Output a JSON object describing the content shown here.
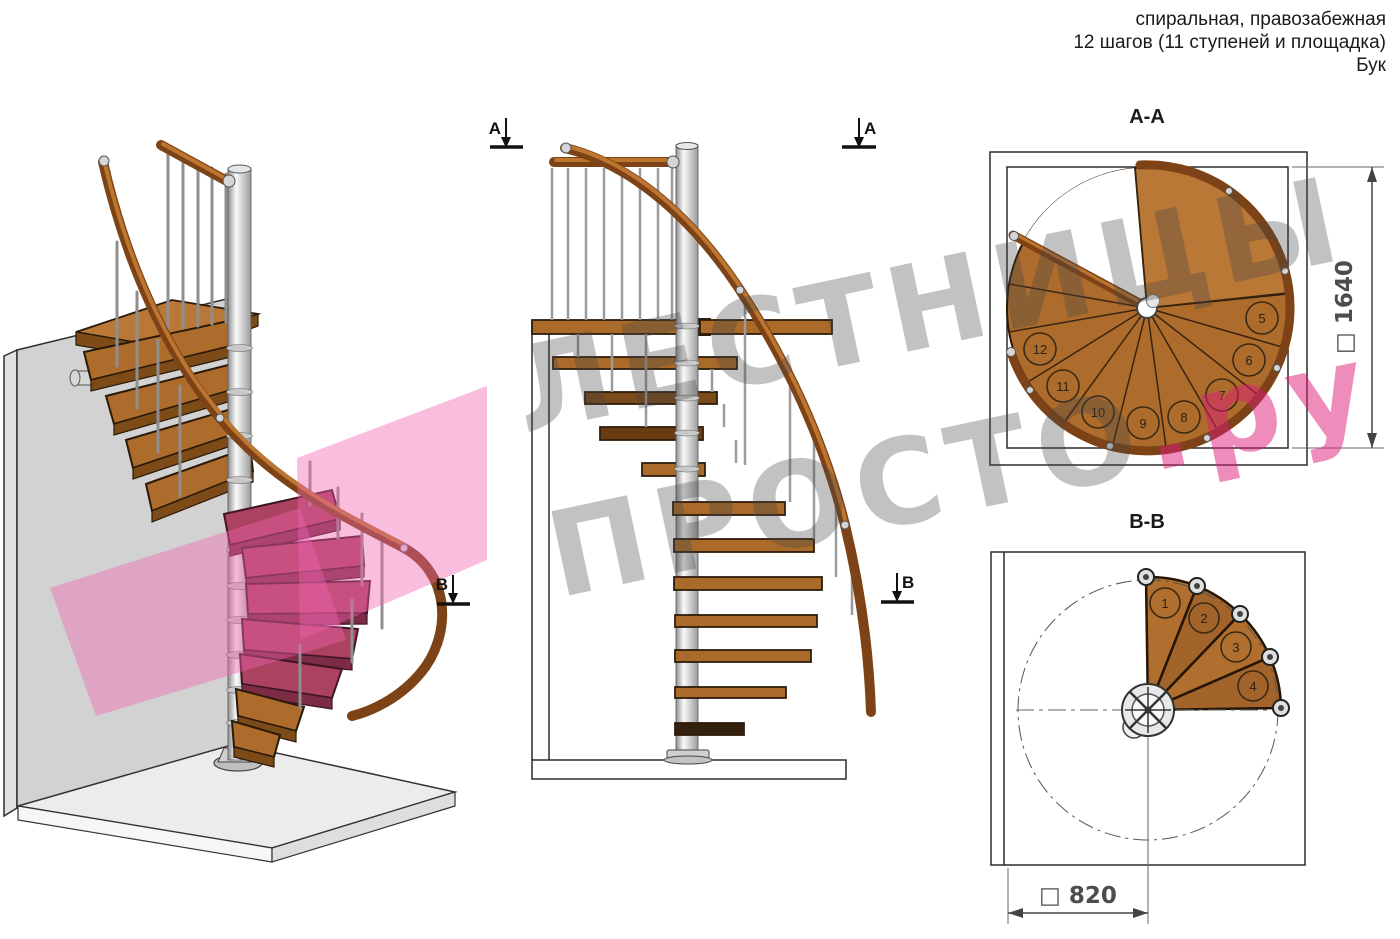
{
  "header": {
    "line1": "спиральная, правозабежная",
    "line2": "12 шагов (11 ступеней и площадка)",
    "line3": "Бук"
  },
  "watermark": {
    "word1": "ЛЕСТНИЦЫ",
    "word2": "ПРОСТО",
    "suffix": ".ру"
  },
  "views": {
    "plan_top": {
      "title": "А-А",
      "dim_label": "□ 1640",
      "steps": [
        "5",
        "6",
        "7",
        "8",
        "9",
        "10",
        "11",
        "12"
      ]
    },
    "plan_bottom": {
      "title": "В-В",
      "dim_label": "□ 820",
      "steps": [
        "1",
        "2",
        "3",
        "4"
      ]
    },
    "elevation": {
      "marker_a": "А",
      "marker_b": "В"
    }
  },
  "colors": {
    "wood": "#ad6c2c",
    "wood_light": "#b97836",
    "rail_brown": "#7d4316",
    "pink_plane": "#ee69b2",
    "pink_tread": "#aa4260",
    "metal": "#d6d6d6",
    "watermark_gray": "#9b9b9b",
    "watermark_pink": "#de1c78"
  }
}
